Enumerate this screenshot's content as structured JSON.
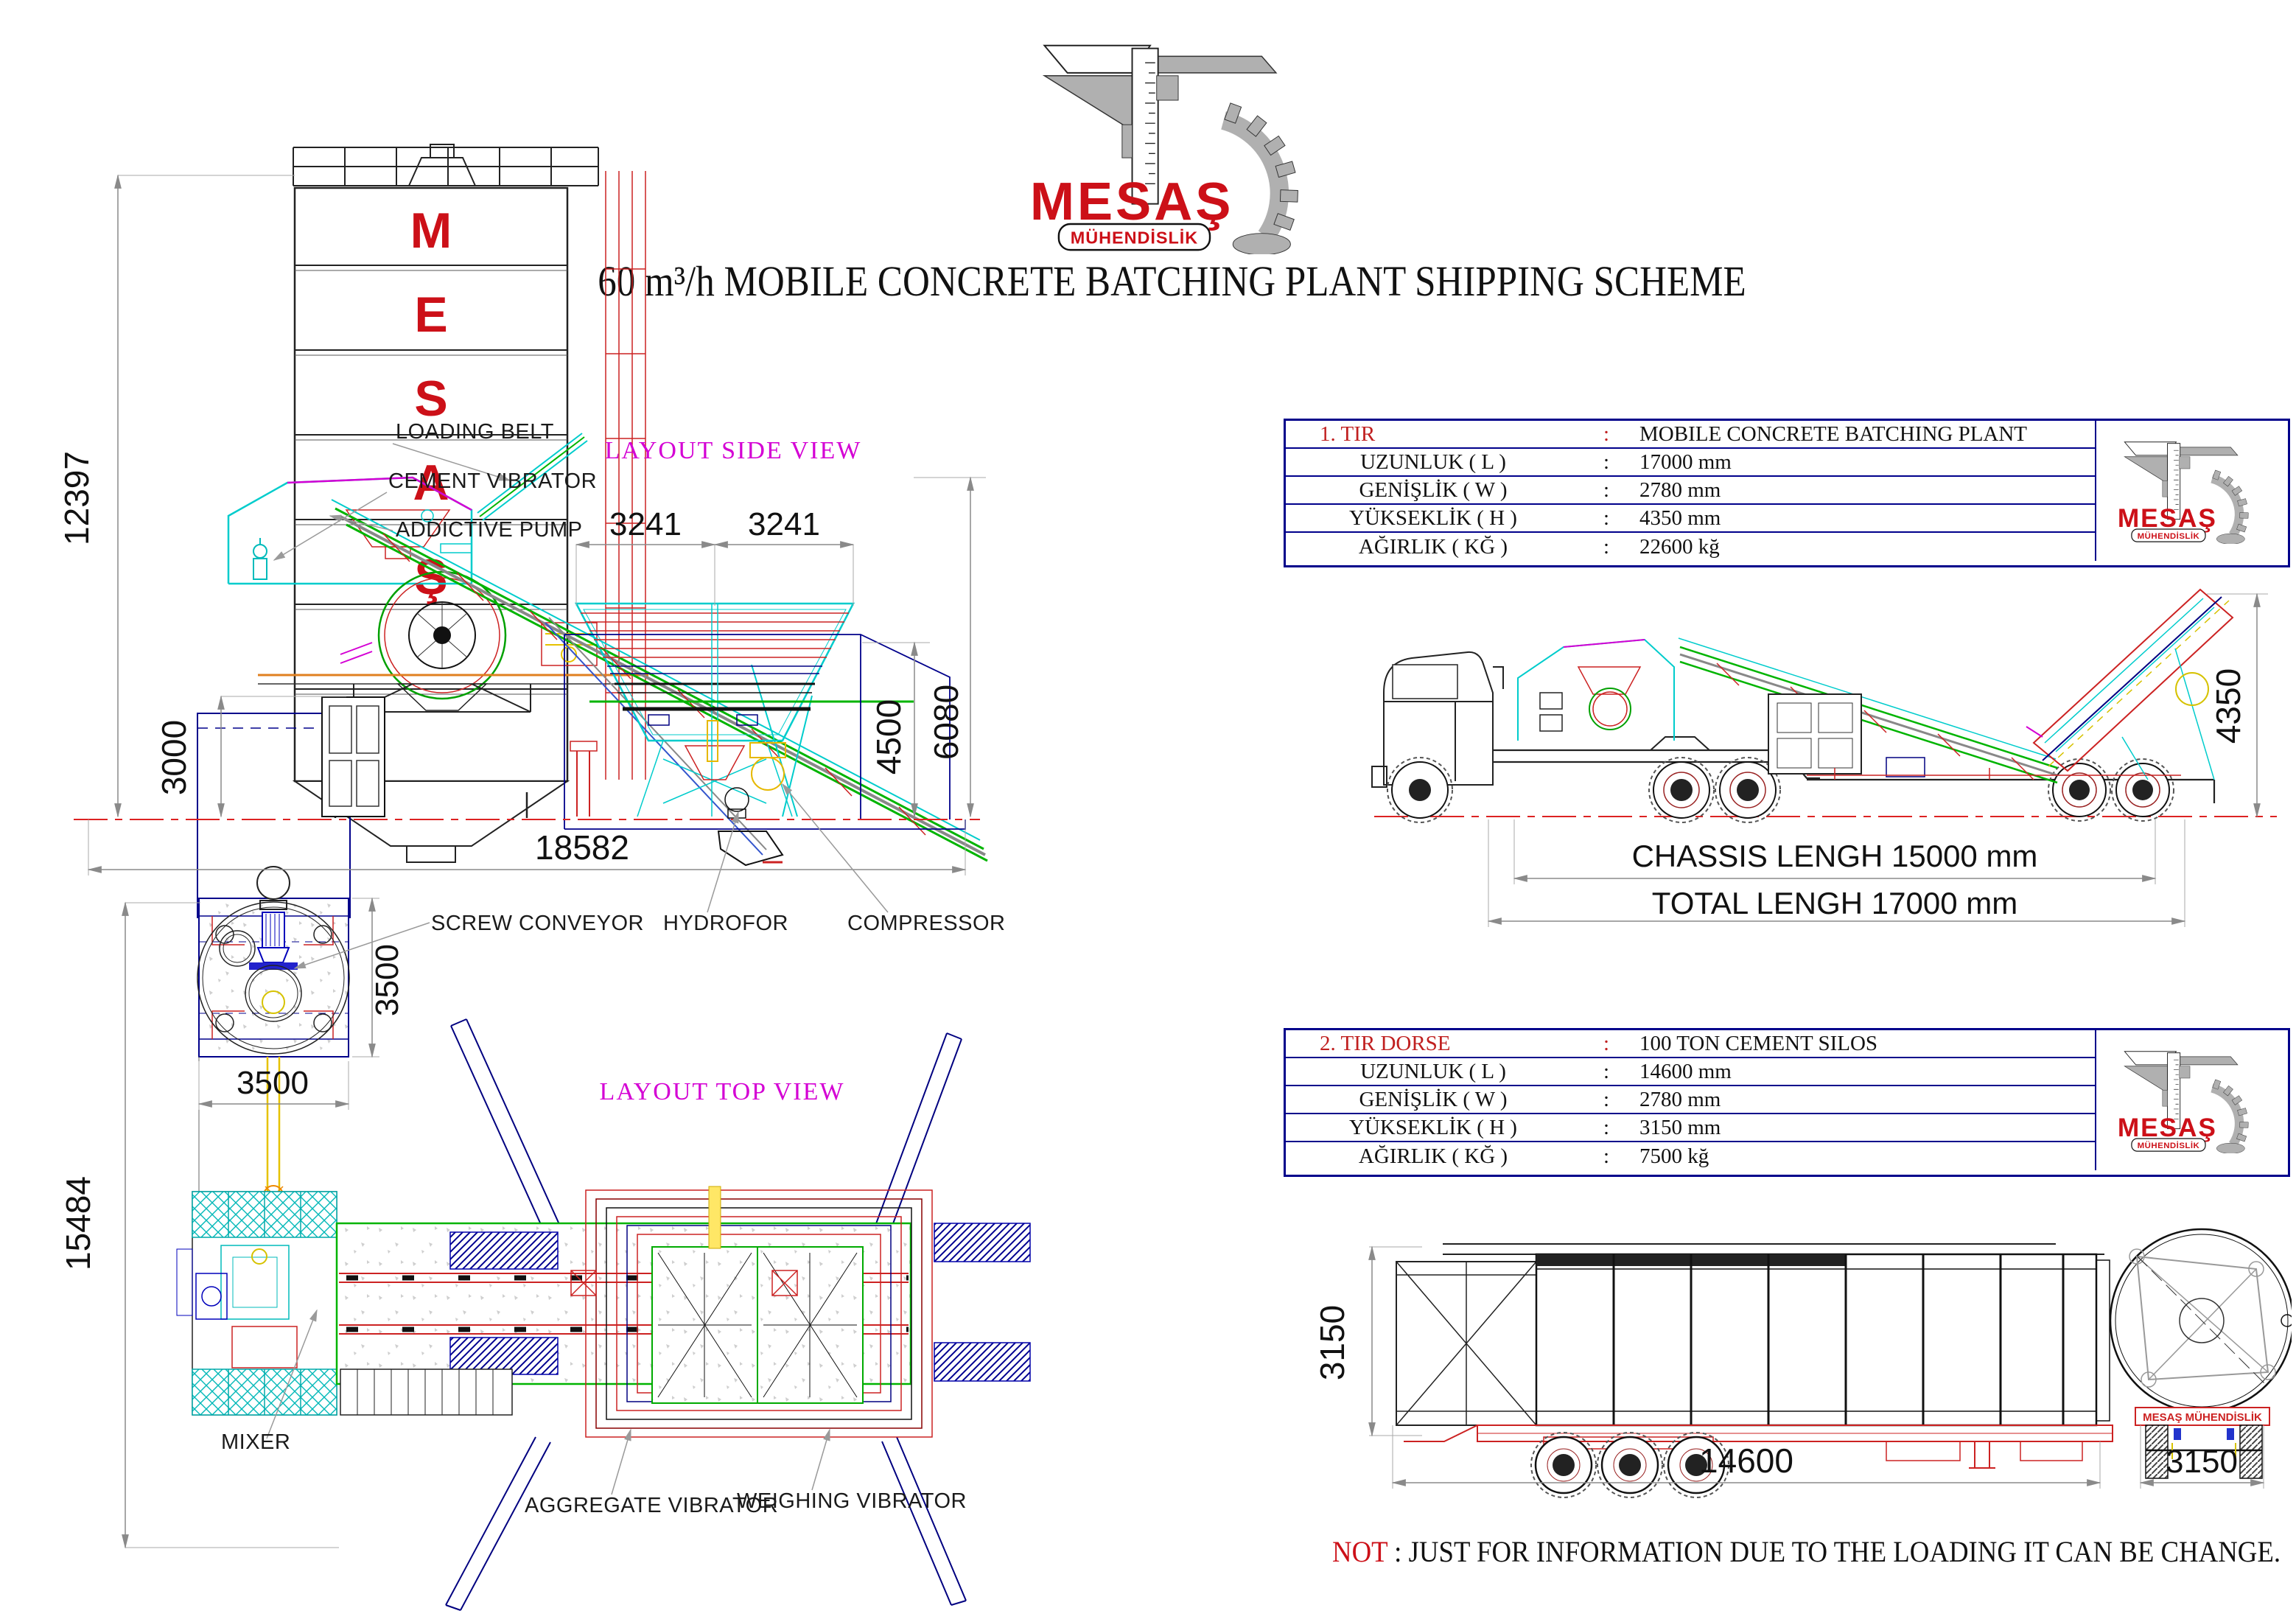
{
  "logo": {
    "name": "MESAŞ",
    "subtitle": "MÜHENDİSLİK"
  },
  "header": {
    "title": "60 m³/h MOBILE CONCRETE BATCHING PLANT SHIPPING SCHEME"
  },
  "side_view": {
    "caption": "LAYOUT SIDE VIEW",
    "silo_letters": [
      "M",
      "E",
      "S",
      "A",
      "Ş"
    ],
    "dims": {
      "total_height": "12397",
      "foundation_height": "3000",
      "total_length": "18582",
      "bin_span_left": "3241",
      "bin_span_right": "3241",
      "bin_height": "4500",
      "plant_height": "6080"
    },
    "labels": {
      "loading_belt": "LOADING BELT",
      "cement_vibrator": "CEMENT VIBRATOR",
      "addictive_pump": "ADDICTIVE PUMP",
      "hydrofor": "HYDROFOR",
      "compressor": "COMPRESSOR"
    }
  },
  "top_view": {
    "caption": "LAYOUT TOP VIEW",
    "dims": {
      "total_width": "15484",
      "silo_pad_width": "3500",
      "silo_pad_depth": "3500"
    },
    "labels": {
      "screw_conveyor": "SCREW CONVEYOR",
      "mixer": "MIXER",
      "aggregate_vibrator": "AGGREGATE VIBRATOR",
      "weighing_vibrator": "WEIGHING VIBRATOR"
    }
  },
  "tir1": {
    "rows": [
      {
        "label": "1. TIR",
        "sep": ":",
        "value": "MOBILE CONCRETE BATCHING PLANT"
      },
      {
        "label": "UZUNLUK ( L )",
        "sep": ":",
        "value": "17000 mm"
      },
      {
        "label": "GENİŞLİK ( W )",
        "sep": ":",
        "value": "2780 mm"
      },
      {
        "label": "YÜKSEKLİK ( H )",
        "sep": ":",
        "value": "4350 mm"
      },
      {
        "label": "AĞIRLIK ( KĞ )",
        "sep": ":",
        "value": "22600 kğ"
      }
    ],
    "dims": {
      "chassis_length": "CHASSIS LENGH 15000 mm",
      "total_length": "TOTAL LENGH 17000 mm",
      "height": "4350"
    }
  },
  "tir2": {
    "rows": [
      {
        "label": "2. TIR DORSE",
        "sep": ":",
        "value": "100 TON CEMENT SILOS"
      },
      {
        "label": "UZUNLUK ( L )",
        "sep": ":",
        "value": "14600 mm"
      },
      {
        "label": "GENİŞLİK ( W )",
        "sep": ":",
        "value": "2780 mm"
      },
      {
        "label": "YÜKSEKLİK ( H )",
        "sep": ":",
        "value": "3150 mm"
      },
      {
        "label": "AĞIRLIK ( KĞ )",
        "sep": ":",
        "value": "7500 kğ"
      }
    ],
    "dims": {
      "length": "14600",
      "height": "3150",
      "rear_width": "3150"
    },
    "brand": "MESAŞ MÜHENDİSLİK"
  },
  "note": {
    "prefix": "NOT",
    "separator": " : ",
    "text": "JUST FOR INFORMATION DUE TO THE LOADING IT CAN BE CHANGE."
  },
  "colors": {
    "logo_red": "#cc1018",
    "table_border_navy": "#00008b",
    "caption_magenta": "#d400d4",
    "cad_red": "#cc2222",
    "cad_cyan": "#00cccc",
    "cad_green": "#00b400",
    "dim_gray": "#8a8a8a"
  }
}
